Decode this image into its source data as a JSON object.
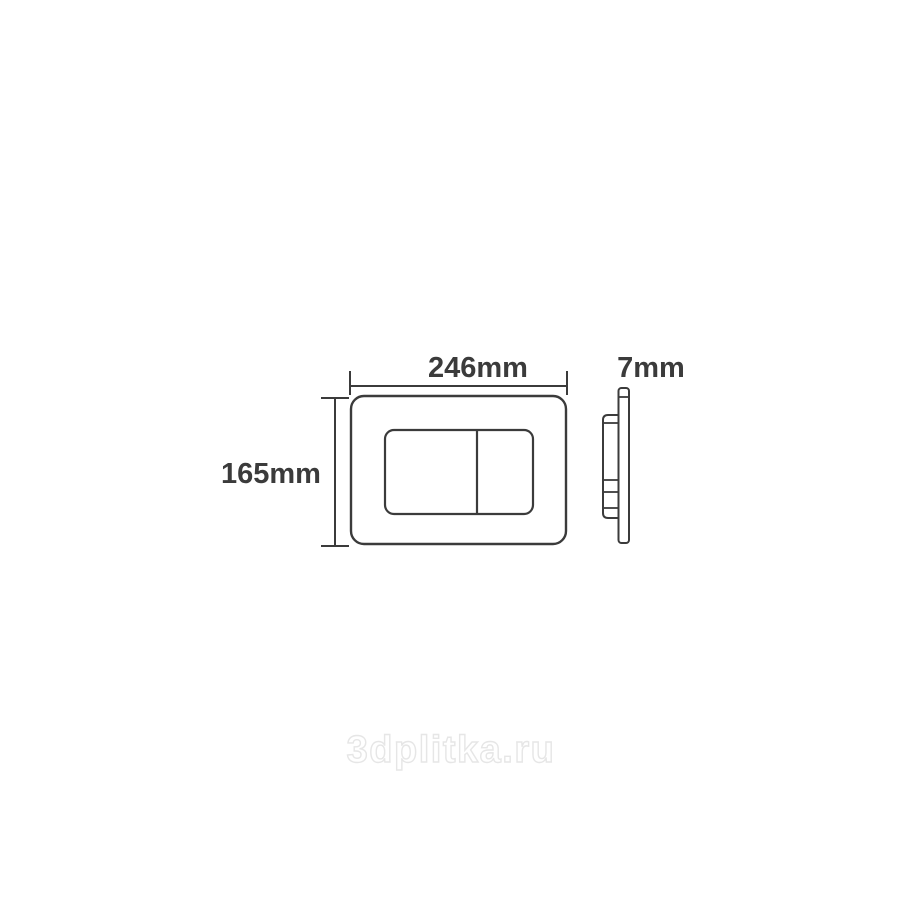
{
  "page": {
    "background_color": "#ffffff"
  },
  "diagram": {
    "type": "technical-drawing",
    "subject": "flush plate — front view and side profile",
    "line_color": "#3b3b3b",
    "dimensions": {
      "width": "246mm",
      "height": "165mm",
      "depth": "7mm"
    }
  },
  "watermark": {
    "text": "3dplitka.ru",
    "color": "#e6e6e6"
  }
}
